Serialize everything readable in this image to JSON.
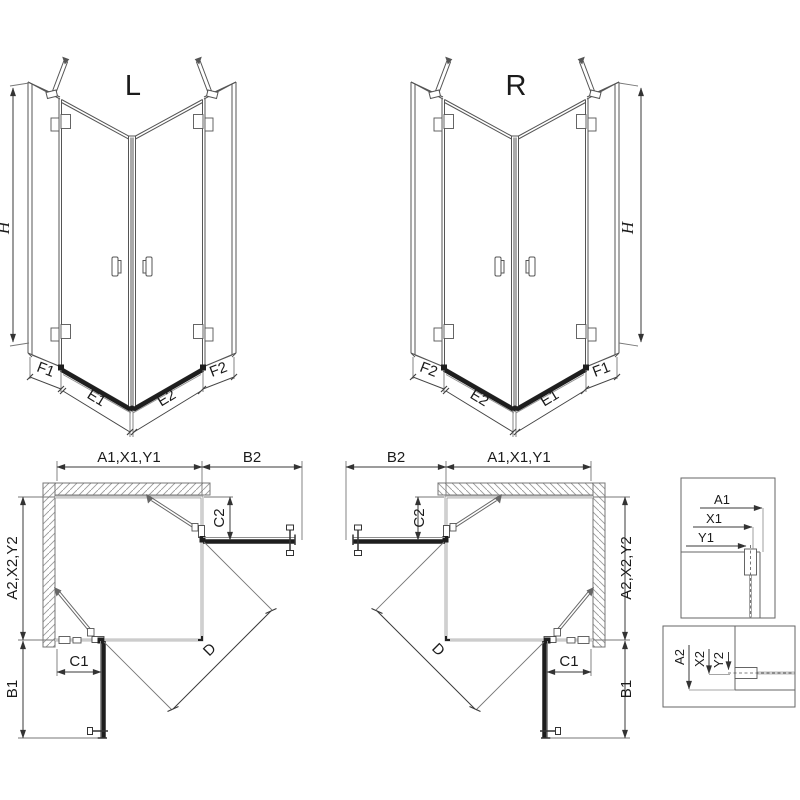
{
  "iso_left": {
    "label": "L",
    "height_dim": "H",
    "bottom_dims": [
      "F1",
      "E1",
      "E2",
      "F2"
    ]
  },
  "iso_right": {
    "label": "R",
    "height_dim": "H",
    "bottom_dims": [
      "F2",
      "E2",
      "E1",
      "F1"
    ]
  },
  "plan_left": {
    "width_dim": "A1,X1,Y1",
    "door_out_dim": "B2",
    "return_top_dim": "C2",
    "depth_dim": "A2,X2,Y2",
    "door_side_dim": "B1",
    "return_side_dim": "C1",
    "diagonal_dim": "D"
  },
  "plan_right": {
    "width_dim": "A1,X1,Y1",
    "door_out_dim": "B2",
    "return_top_dim": "C2",
    "depth_dim": "A2,X2,Y2",
    "door_side_dim": "B1",
    "return_side_dim": "C1",
    "diagonal_dim": "D"
  },
  "detail_top": {
    "dims": [
      "A1",
      "X1",
      "Y1"
    ]
  },
  "detail_bottom": {
    "dims": [
      "A2",
      "X2",
      "Y2"
    ]
  },
  "colors": {
    "line": "#4d4d4d",
    "thin_glass": "#8f8f8f",
    "dark_bar": "#1e1e1e",
    "hatch": "#999999"
  }
}
